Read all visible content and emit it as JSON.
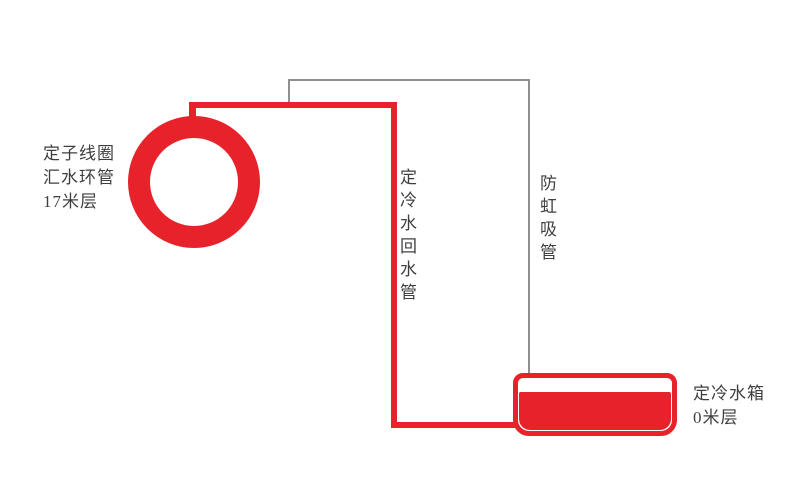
{
  "diagram": {
    "labels": {
      "stator_ring": "定子线圈\n汇水环管\n17米层",
      "return_pipe": "定冷水回水管",
      "anti_siphon_pipe": "防虹吸管",
      "tank": "定冷水箱\n0米层"
    },
    "colors": {
      "pipe_red": "#e8222b",
      "line_gray": "#8f8f8f",
      "text_color": "#3f3f3f",
      "bg": "#ffffff"
    }
  }
}
